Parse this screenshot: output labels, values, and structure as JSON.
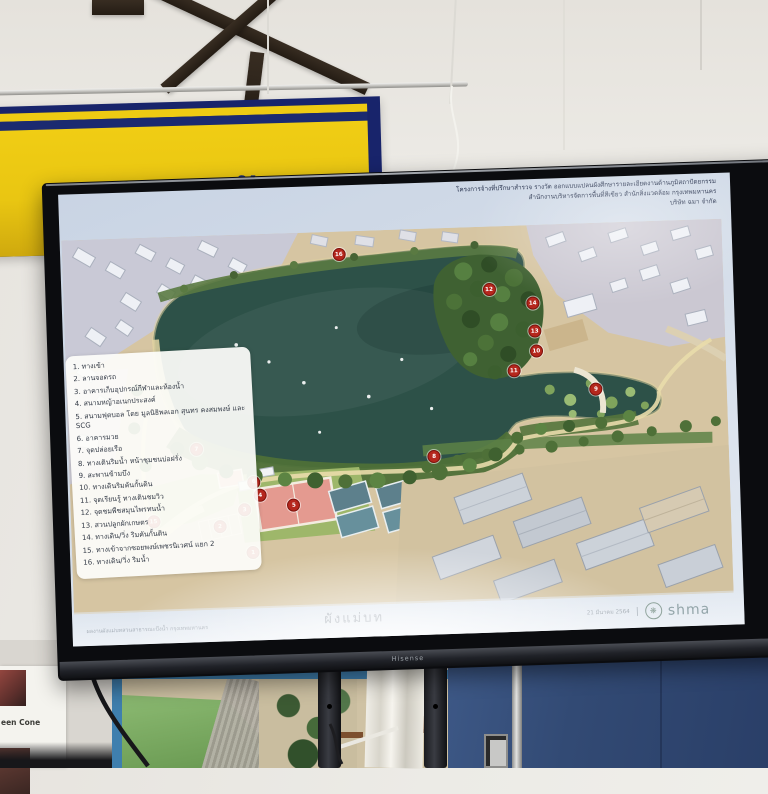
{
  "scene": {
    "description": "photo of a TV in a meeting room showing a park master plan slide",
    "tv_brand_label": "Hisense"
  },
  "banner": {
    "text_fragment": "ไฟ้ อ ชั้ ฆ",
    "yellow": "#e9c612",
    "navy": "#18246b"
  },
  "slide": {
    "title_lines": [
      "โครงการจ้างที่ปรึกษาสำรวจ รางวัด ออกแบบแปลนผังศึกษารายละเอียดงานด้านภูมิสถาปัตยกรรม",
      "สำนักงานบริหารจัดการพื้นที่สีเขียว สำนักสิ่งแวดล้อม กรุงเทพมหานคร",
      "บริษัท ฉมา จำกัด"
    ],
    "legend": {
      "items": [
        {
          "no": "1.",
          "label": "ทางเข้า"
        },
        {
          "no": "2.",
          "label": "ลานจอดรถ"
        },
        {
          "no": "3.",
          "label": "อาคารเก็บอุปกรณ์กีฬาและห้องน้ำ"
        },
        {
          "no": "4.",
          "label": "สนามหญ้าอเนกประสงค์"
        },
        {
          "no": "5.",
          "label": "สนามฟุตบอล โดย มูลนิธิพลเอก สุนทร คงสมพงษ์ และ SCG"
        },
        {
          "no": "6.",
          "label": "อาคารมวย"
        },
        {
          "no": "7.",
          "label": "จุดปล่อยเรือ"
        },
        {
          "no": "8.",
          "label": "ทางเดินริมน้ำ หน้าชุมชนบ่อฝรั่ง"
        },
        {
          "no": "9.",
          "label": "สะพานข้ามบึง"
        },
        {
          "no": "10.",
          "label": "ทางเดินริมคันกั้นดิน"
        },
        {
          "no": "11.",
          "label": "จุดเรียนรู้ ทางเดินชมวิว"
        },
        {
          "no": "12.",
          "label": "จุดชมพืชสมุนไพรทนน้ำ"
        },
        {
          "no": "13.",
          "label": "สวนปลูกผักเกษตร"
        },
        {
          "no": "14.",
          "label": "ทางเดิน/วิ่ง ริมคันกั้นดิน"
        },
        {
          "no": "15.",
          "label": "ทางเข้าจากซอยพงษ์เพชรนิเวศน์ แยก 2"
        },
        {
          "no": "16.",
          "label": "ทางเดิน/วิ่ง ริมน้ำ"
        }
      ]
    },
    "footer": {
      "caption_left": "ผลงานผังแม่บทสวนสาธารณะบึงน้ำ กรุงเทพมหานคร",
      "plan_label": "ผังแม่บท",
      "date": "21 มีนาคม 2564",
      "divider": "|",
      "logo_glyph": "❋",
      "logo_word": "shma"
    },
    "map": {
      "lake_color": "#2d5148",
      "marker_color": "#b5271d",
      "markers": [
        {
          "n": "1",
          "x": 180,
          "y": 318
        },
        {
          "n": "2",
          "x": 148,
          "y": 291
        },
        {
          "n": "3",
          "x": 173,
          "y": 275
        },
        {
          "n": "4",
          "x": 189,
          "y": 261
        },
        {
          "n": "5",
          "x": 222,
          "y": 272
        },
        {
          "n": "6",
          "x": 183,
          "y": 248
        },
        {
          "n": "7",
          "x": 127,
          "y": 213
        },
        {
          "n": "8",
          "x": 363,
          "y": 228
        },
        {
          "n": "9",
          "x": 526,
          "y": 166
        },
        {
          "n": "10",
          "x": 468,
          "y": 126
        },
        {
          "n": "11",
          "x": 445,
          "y": 145
        },
        {
          "n": "12",
          "x": 423,
          "y": 63
        },
        {
          "n": "13",
          "x": 467,
          "y": 106
        },
        {
          "n": "14",
          "x": 466,
          "y": 78
        },
        {
          "n": "15",
          "x": 82,
          "y": 284
        },
        {
          "n": "16",
          "x": 275,
          "y": 23
        }
      ]
    }
  },
  "below_tv": {
    "poster_caption": "een Cone"
  }
}
